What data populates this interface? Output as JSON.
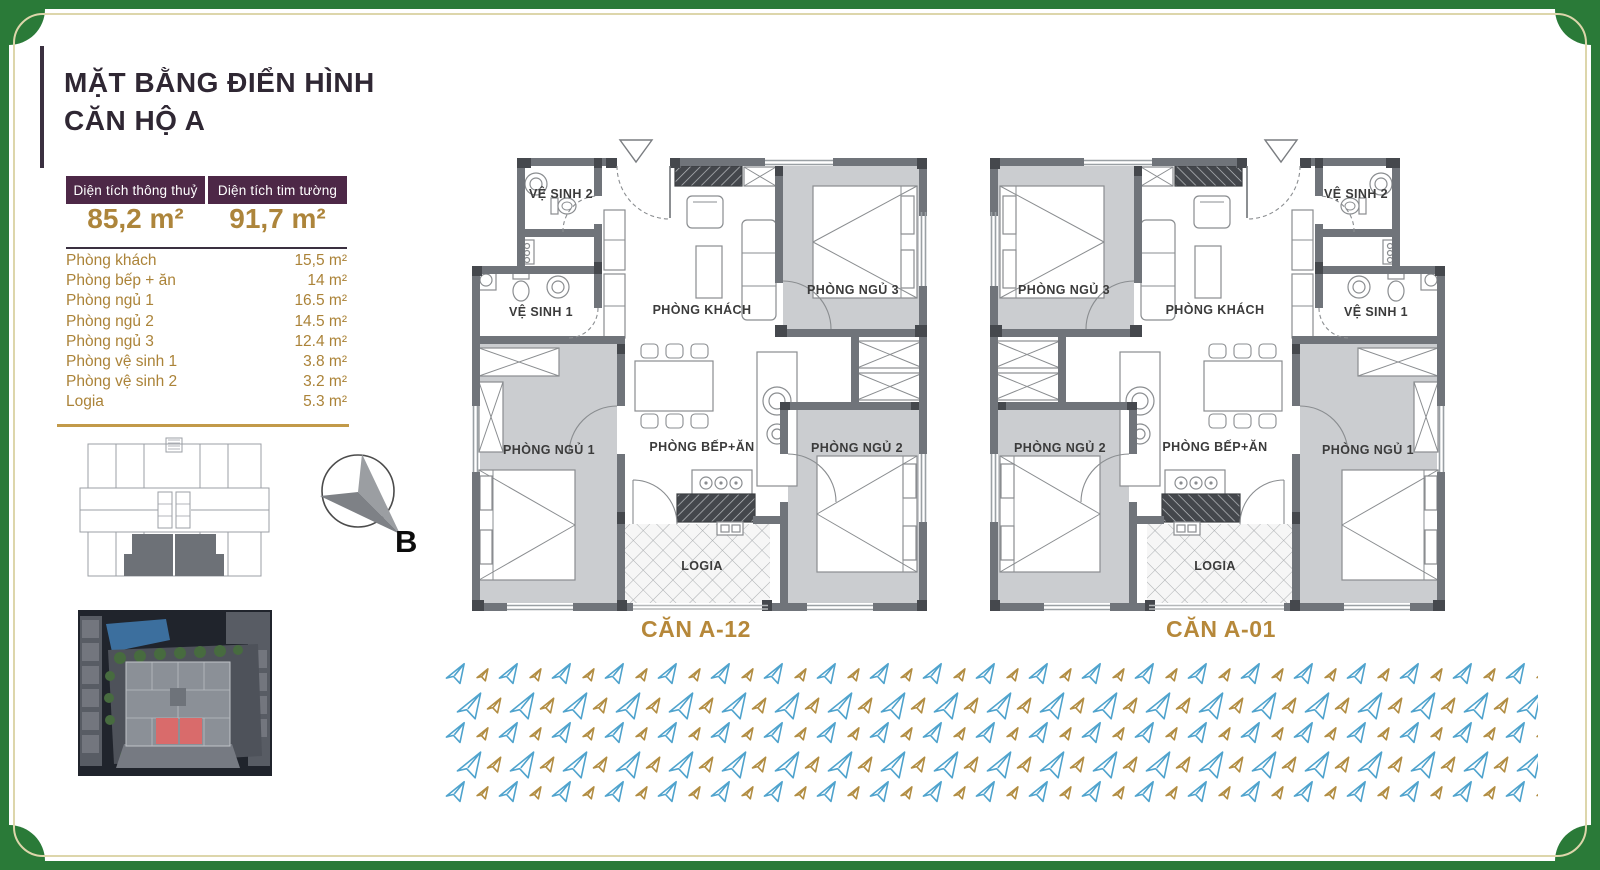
{
  "header": {
    "title_line1": "MẶT BẰNG ĐIỂN HÌNH",
    "title_line2": "CĂN HỘ A"
  },
  "area_summary": {
    "columns": [
      {
        "header": "Diện tích thông thuỷ",
        "value": "85,2 m²"
      },
      {
        "header": "Diện tích tim tường",
        "value": "91,7 m²"
      }
    ]
  },
  "room_areas": [
    {
      "label": "Phòng khách",
      "area": "15,5 m²"
    },
    {
      "label": "Phòng bếp + ăn",
      "area": "14 m²"
    },
    {
      "label": "Phòng ngủ 1",
      "area": "16.5 m²"
    },
    {
      "label": "Phòng ngủ 2",
      "area": "14.5 m²"
    },
    {
      "label": "Phòng ngủ 3",
      "area": "12.4 m²"
    },
    {
      "label": "Phòng vệ sinh 1",
      "area": "3.8 m²"
    },
    {
      "label": "Phòng vệ sinh 2",
      "area": "3.2 m²"
    },
    {
      "label": "Logia",
      "area": "5.3 m²"
    }
  ],
  "compass": {
    "label": "B"
  },
  "floor_plans": {
    "room_labels": {
      "living": "PHÒNG KHÁCH",
      "kitchen": "PHÒNG BẾP+ĂN",
      "bedroom1": "PHÒNG NGỦ 1",
      "bedroom2": "PHÒNG NGỦ 2",
      "bedroom3": "PHÒNG NGỦ 3",
      "bathroom1": "VỆ SINH 1",
      "bathroom2": "VỆ SINH 2",
      "logia": "LOGIA"
    },
    "units": [
      {
        "name": "CĂN A-12"
      },
      {
        "name": "CĂN A-01"
      }
    ]
  },
  "colors": {
    "frame_green": "#2a7a38",
    "frame_inner_line": "#ddd6ab",
    "accent_gold": "#b6883a",
    "table_header_plum": "#4d2847",
    "wall_gray": "#70747a",
    "room_fill_gray": "#cbcdd0",
    "watermark_blue": "#4fa3cd",
    "watermark_gold": "#b28d42",
    "site_highlight_red": "#d96b6b"
  }
}
